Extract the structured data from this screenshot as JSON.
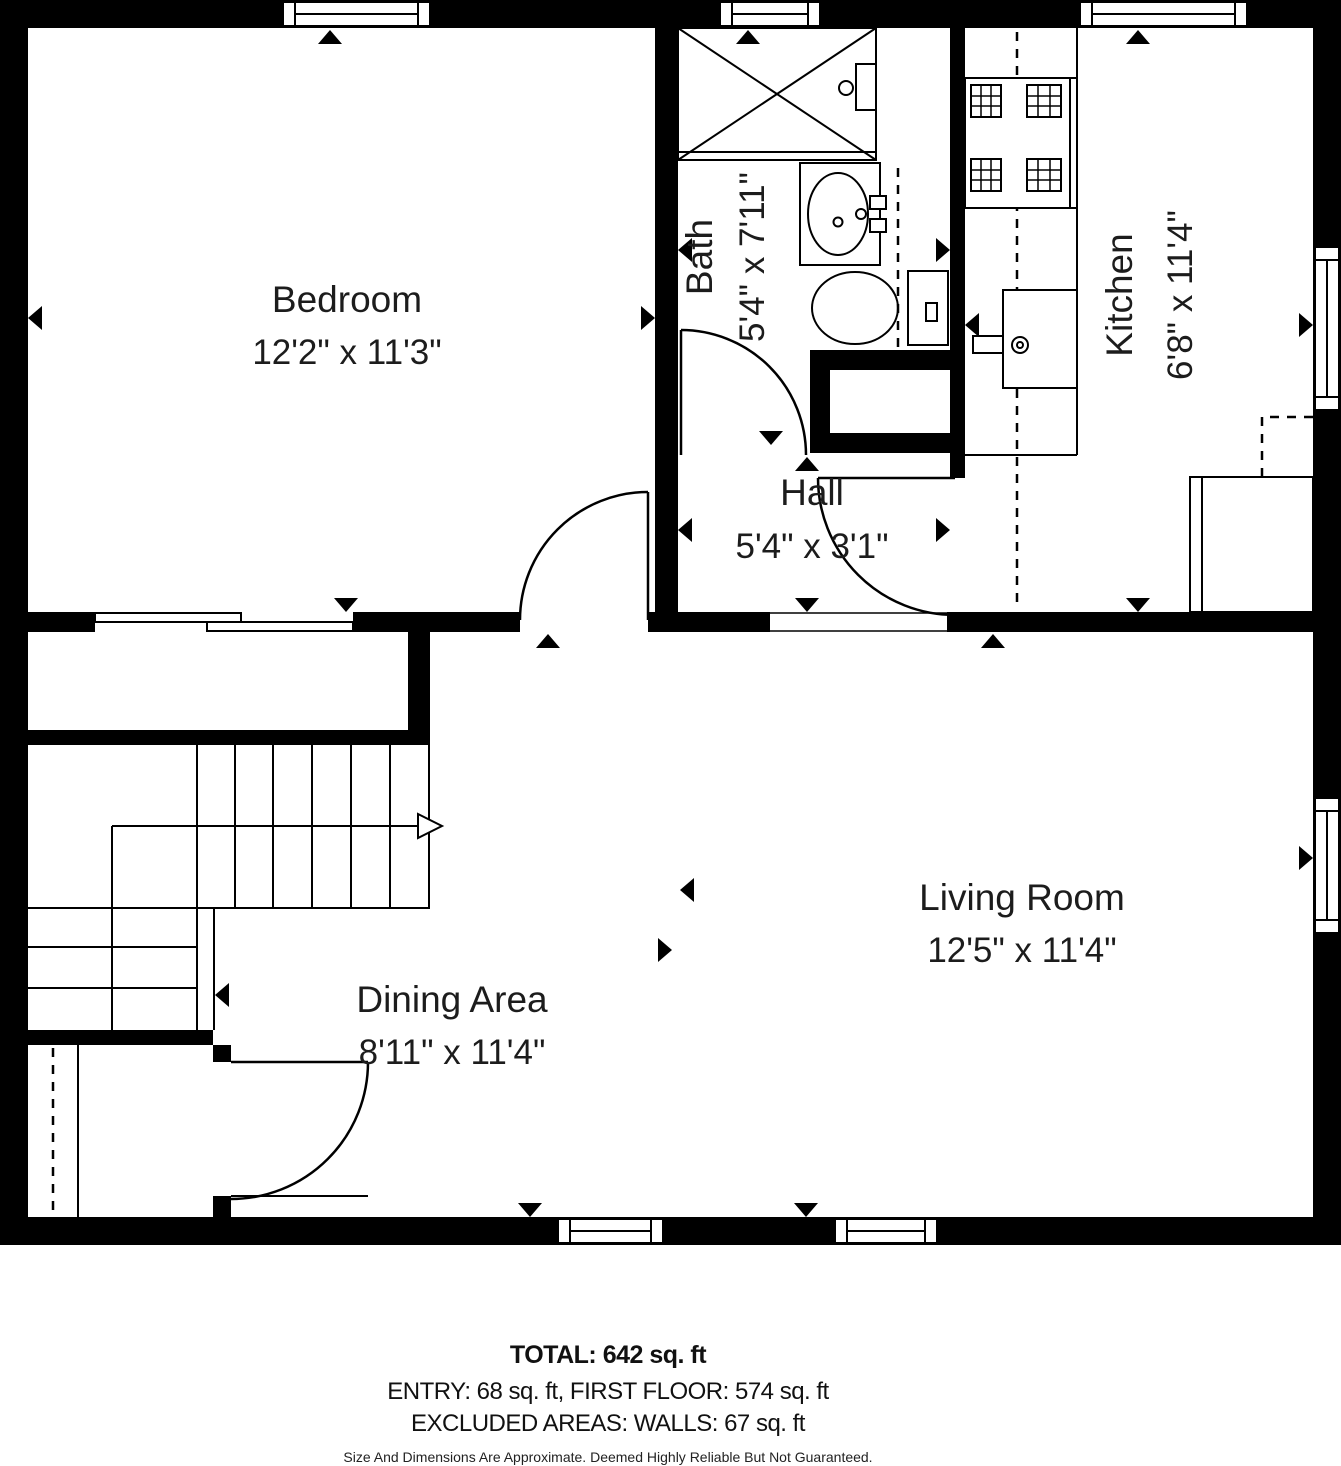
{
  "plan": {
    "rooms": {
      "bedroom": {
        "name": "Bedroom",
        "dims": "12'2\" x 11'3\""
      },
      "bath": {
        "name": "Bath",
        "dims": "5'4\" x 7'11\""
      },
      "kitchen": {
        "name": "Kitchen",
        "dims": "6'8\" x 11'4\""
      },
      "hall": {
        "name": "Hall",
        "dims": "5'4\" x 3'1\""
      },
      "living": {
        "name": "Living Room",
        "dims": "12'5\" x 11'4\""
      },
      "dining": {
        "name": "Dining Area",
        "dims": "8'11\" x 11'4\""
      }
    },
    "colors": {
      "wall": "#000000",
      "floor": "#ffffff",
      "text": "#1c1c1c"
    }
  },
  "footer": {
    "total": "TOTAL: 642 sq. ft",
    "breakdown": "ENTRY: 68 sq. ft, FIRST FLOOR: 574 sq. ft",
    "excluded": "EXCLUDED AREAS: WALLS: 67 sq. ft",
    "disclaimer": "Size And Dimensions Are Approximate. Deemed Highly Reliable But Not Guaranteed."
  }
}
